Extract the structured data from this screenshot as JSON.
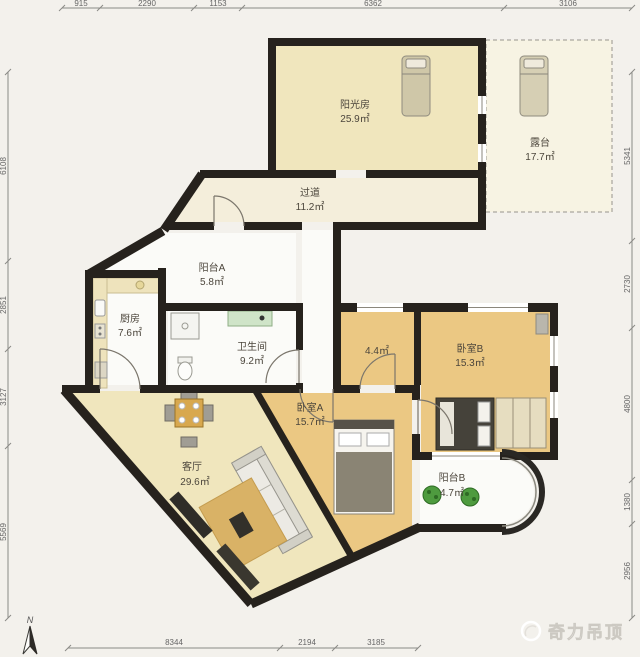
{
  "title": "apartment-floor-plan",
  "watermark": {
    "text": "奇力吊顶"
  },
  "compass": {
    "label": "N"
  },
  "dimensions": {
    "top": [
      "915",
      "2290",
      "1153",
      "6362",
      "3106"
    ],
    "left": [
      "6108",
      "2851",
      "3127",
      "5569"
    ],
    "right": [
      "5341",
      "2730",
      "4800",
      "1380",
      "2956"
    ],
    "bottom": [
      "8344",
      "2194",
      "3185"
    ]
  },
  "rooms": [
    {
      "name": "阳光房",
      "area": "25.9㎡"
    },
    {
      "name": "露台",
      "area": "17.7㎡"
    },
    {
      "name": "过道",
      "area": "11.2㎡"
    },
    {
      "name": "阳台A",
      "area": "5.8㎡"
    },
    {
      "name": "厨房",
      "area": "7.6㎡"
    },
    {
      "name": "卫生间",
      "area": "9.2㎡"
    },
    {
      "name": "",
      "area": "4.4㎡"
    },
    {
      "name": "卧室B",
      "area": "15.3㎡"
    },
    {
      "name": "卧室A",
      "area": "15.7㎡"
    },
    {
      "name": "客厅",
      "area": "29.6㎡"
    },
    {
      "name": "阳台B",
      "area": "4.7㎡"
    }
  ],
  "colors": {
    "wall": "#26221d",
    "floor_cream": "#f0e6bd",
    "floor_wood": "#ebc883",
    "floor_white": "#fbfbf8",
    "floor_terrace": "#f7f3e3",
    "plant_green": "#4e9b3f",
    "vanity_green": "#cfe4c8",
    "table_wood": "#d8a84e",
    "background": "#f3f1ec"
  }
}
